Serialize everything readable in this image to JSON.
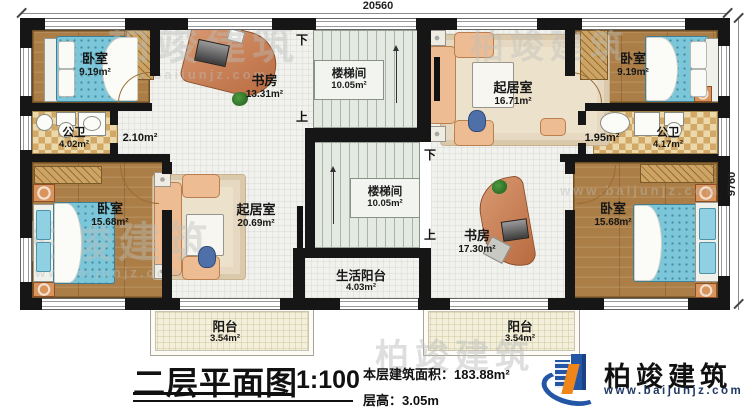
{
  "dimensions": {
    "top": "20560",
    "right": "9760"
  },
  "stairs": {
    "up": "上",
    "down": "下"
  },
  "rooms": {
    "bedroom_tl": {
      "name": "卧室",
      "area": "9.19m²"
    },
    "study_tl": {
      "name": "书房",
      "area": "13.31m²"
    },
    "stair_top": {
      "name": "楼梯间",
      "area": "10.05m²"
    },
    "living_tr": {
      "name": "起居室",
      "area": "16.71m²"
    },
    "bedroom_tr": {
      "name": "卧室",
      "area": "9.19m²"
    },
    "bath_left": {
      "name": "公卫",
      "area": "4.02m²"
    },
    "hall_left": {
      "area": "2.10m²"
    },
    "hall_right": {
      "area": "1.95m²"
    },
    "bath_right": {
      "name": "公卫",
      "area": "4.17m²"
    },
    "bedroom_bl": {
      "name": "卧室",
      "area": "15.68m²"
    },
    "living_bl": {
      "name": "起居室",
      "area": "20.69m²"
    },
    "stair_bottom": {
      "name": "楼梯间",
      "area": "10.05m²"
    },
    "study_br": {
      "name": "书房",
      "area": "17.30m²"
    },
    "bedroom_br": {
      "name": "卧室",
      "area": "15.68m²"
    },
    "service_balcony": {
      "name": "生活阳台",
      "area": "4.03m²"
    },
    "balcony_left": {
      "name": "阳台",
      "area": "3.54m²"
    },
    "balcony_right": {
      "name": "阳台",
      "area": "3.54m²"
    }
  },
  "title_block": {
    "plan_title": "二层平面图",
    "scale": "1:100",
    "floor_area_label": "本层建筑面积：",
    "floor_area_value": "183.88m²",
    "floor_height_label": "层高：",
    "floor_height_value": "3.05m"
  },
  "brand": {
    "name": "柏竣建筑",
    "website": "www.baijunjz.com"
  },
  "watermark": {
    "text": "柏竣建筑",
    "website": "www.baijunjz.com"
  },
  "colors": {
    "wall": "#161616",
    "wood_floor": "#ab7e47",
    "tile": "#d2a867",
    "stair_floor": "#e4e9e1",
    "bed": "#7cc6da",
    "sofa": "#eebc92",
    "desk": "#c9805c",
    "brand_blue": "#2456a6",
    "brand_orange": "#f08519"
  }
}
